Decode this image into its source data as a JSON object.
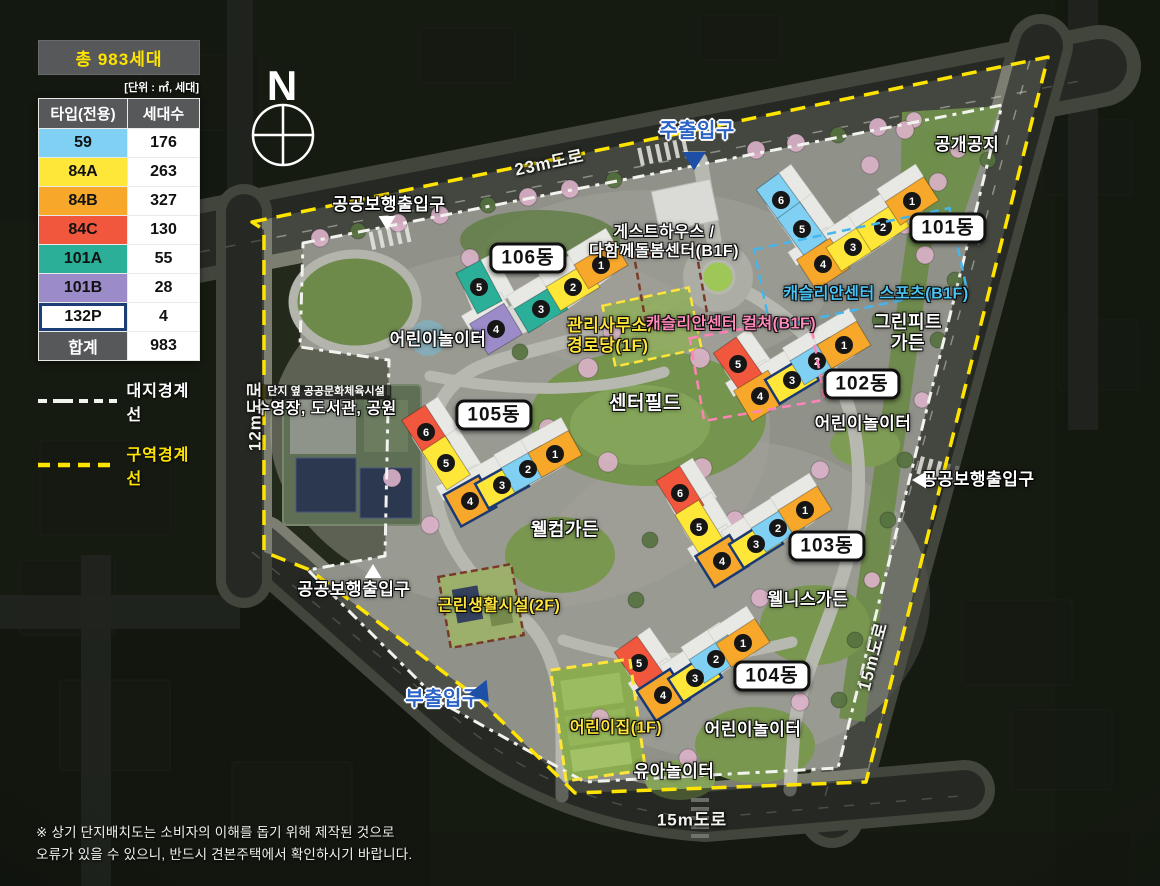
{
  "legend": {
    "title": "총 983세대",
    "unit_note": "[단위 : ㎡,  세대]",
    "col_type": "타입(전용)",
    "col_count": "세대수",
    "rows": [
      {
        "type": "59",
        "count": "176",
        "color": "#7fd0f2"
      },
      {
        "type": "84A",
        "count": "263",
        "color": "#ffe73a"
      },
      {
        "type": "84B",
        "count": "327",
        "color": "#f7a82b"
      },
      {
        "type": "84C",
        "count": "130",
        "color": "#f1573d"
      },
      {
        "type": "101A",
        "count": "55",
        "color": "#2baf98"
      },
      {
        "type": "101B",
        "count": "28",
        "color": "#9c8bc9"
      },
      {
        "type": "132P",
        "count": "4",
        "color": "#ffffff",
        "border": "#1c3e77"
      }
    ],
    "total_label": "합계",
    "total_count": "983",
    "boundary_site": "대지경계선",
    "boundary_zone": "구역경계선",
    "boundary_site_color": "#f2f2ee",
    "boundary_zone_color": "#ffe400"
  },
  "compass": {
    "label": "N"
  },
  "disclaimer": {
    "line1": "※ 상기 단지배치도는 소비자의 이해를 돕기 위해 제작된 것으로",
    "line2": "오류가 있을 수 있으니, 반드시 견본주택에서 확인하시기 바랍니다."
  },
  "site": {
    "unit_badge_color": "#161616",
    "buildings": [
      {
        "name": "101동",
        "pill": {
          "x": 948,
          "y": 228
        },
        "sections": [
          {
            "n": 6,
            "t": "59",
            "x": 781,
            "y": 200,
            "r": 54
          },
          {
            "n": 5,
            "t": "59",
            "x": 802,
            "y": 229,
            "r": 54
          },
          {
            "n": 4,
            "t": "84B",
            "x": 823,
            "y": 264,
            "r": -33,
            "c": true
          },
          {
            "n": 3,
            "t": "84A",
            "x": 853,
            "y": 247,
            "r": -33
          },
          {
            "n": 2,
            "t": "84A",
            "x": 883,
            "y": 227,
            "r": -33
          },
          {
            "n": 1,
            "t": "84B",
            "x": 912,
            "y": 201,
            "r": -33
          }
        ]
      },
      {
        "name": "102동",
        "pill": {
          "x": 862,
          "y": 384
        },
        "sections": [
          {
            "n": 5,
            "t": "84C",
            "x": 738,
            "y": 364,
            "r": 55
          },
          {
            "n": 4,
            "t": "84B",
            "x": 760,
            "y": 396,
            "r": -31,
            "c": true
          },
          {
            "n": 3,
            "t": "84A",
            "x": 792,
            "y": 380,
            "r": -31,
            "navy": true
          },
          {
            "n": 2,
            "t": "59",
            "x": 817,
            "y": 361,
            "r": -31
          },
          {
            "n": 1,
            "t": "84B",
            "x": 844,
            "y": 345,
            "r": -31
          }
        ]
      },
      {
        "name": "103동",
        "pill": {
          "x": 827,
          "y": 546
        },
        "sections": [
          {
            "n": 6,
            "t": "84C",
            "x": 680,
            "y": 493,
            "r": 58
          },
          {
            "n": 5,
            "t": "84A",
            "x": 699,
            "y": 527,
            "r": 58
          },
          {
            "n": 4,
            "t": "84B",
            "x": 722,
            "y": 561,
            "r": -32,
            "c": true,
            "navy": true
          },
          {
            "n": 3,
            "t": "84A",
            "x": 756,
            "y": 544,
            "r": -32,
            "navy": true
          },
          {
            "n": 2,
            "t": "59",
            "x": 778,
            "y": 528,
            "r": -32
          },
          {
            "n": 1,
            "t": "84B",
            "x": 805,
            "y": 510,
            "r": -32
          }
        ]
      },
      {
        "name": "104동",
        "pill": {
          "x": 772,
          "y": 676
        },
        "sections": [
          {
            "n": 5,
            "t": "84C",
            "x": 639,
            "y": 663,
            "r": 55
          },
          {
            "n": 4,
            "t": "84B",
            "x": 663,
            "y": 695,
            "r": -33,
            "c": true,
            "navy": true
          },
          {
            "n": 3,
            "t": "84A",
            "x": 695,
            "y": 678,
            "r": -33,
            "navy": true
          },
          {
            "n": 2,
            "t": "59",
            "x": 716,
            "y": 659,
            "r": -33
          },
          {
            "n": 1,
            "t": "84B",
            "x": 743,
            "y": 643,
            "r": -33
          }
        ]
      },
      {
        "name": "105동",
        "pill": {
          "x": 494,
          "y": 415
        },
        "sections": [
          {
            "n": 6,
            "t": "84C",
            "x": 426,
            "y": 432,
            "r": 57
          },
          {
            "n": 5,
            "t": "84A",
            "x": 446,
            "y": 463,
            "r": 57
          },
          {
            "n": 4,
            "t": "84B",
            "x": 470,
            "y": 501,
            "r": -29,
            "c": true,
            "navy": true
          },
          {
            "n": 3,
            "t": "84A",
            "x": 502,
            "y": 485,
            "r": -29,
            "navy": true
          },
          {
            "n": 2,
            "t": "59",
            "x": 528,
            "y": 469,
            "r": -29
          },
          {
            "n": 1,
            "t": "84B",
            "x": 555,
            "y": 454,
            "r": -29
          }
        ]
      },
      {
        "name": "106동",
        "pill": {
          "x": 528,
          "y": 258
        },
        "sections": [
          {
            "n": 5,
            "t": "101A",
            "x": 479,
            "y": 287,
            "r": 62
          },
          {
            "n": 4,
            "t": "101B",
            "x": 496,
            "y": 329,
            "r": -31,
            "c": true
          },
          {
            "n": 3,
            "t": "101A",
            "x": 541,
            "y": 309,
            "r": -31
          },
          {
            "n": 2,
            "t": "84A",
            "x": 573,
            "y": 287,
            "r": -31
          },
          {
            "n": 1,
            "t": "84B",
            "x": 601,
            "y": 265,
            "r": -31
          }
        ]
      }
    ]
  },
  "map_labels": [
    {
      "id": "open-space",
      "text": "공개공지",
      "x": 967,
      "y": 145,
      "s": "w",
      "fs": 17
    },
    {
      "id": "greenfit-garden",
      "text": "그린피트\n가든",
      "x": 908,
      "y": 333,
      "s": "w",
      "fs": 18
    },
    {
      "id": "center-field",
      "text": "센터필드",
      "x": 645,
      "y": 404,
      "s": "w",
      "fs": 19
    },
    {
      "id": "kids-playground-nw",
      "text": "어린이놀이터",
      "x": 438,
      "y": 340,
      "s": "w",
      "fs": 17
    },
    {
      "id": "kids-playground-e",
      "text": "어린이놀이터",
      "x": 863,
      "y": 424,
      "s": "w",
      "fs": 17
    },
    {
      "id": "kids-playground-s",
      "text": "어린이놀이터",
      "x": 753,
      "y": 730,
      "s": "w",
      "fs": 17
    },
    {
      "id": "welcome-garden",
      "text": "웰컴가든",
      "x": 565,
      "y": 530,
      "s": "w",
      "fs": 18
    },
    {
      "id": "wellness-garden",
      "text": "웰니스가든",
      "x": 808,
      "y": 600,
      "s": "w",
      "fs": 17
    },
    {
      "id": "toddler-playground",
      "text": "유아놀이터",
      "x": 674,
      "y": 772,
      "s": "w",
      "fs": 17
    },
    {
      "id": "guesthouse-care-center",
      "text": "게스트하우스 /\n다함께돌봄센터(B1F)",
      "x": 664,
      "y": 243,
      "s": "w",
      "fs": 16
    },
    {
      "id": "public-sports-note",
      "text": "단지 옆 공공문화체육시설",
      "x": 326,
      "y": 392,
      "s": "chip",
      "fs": 11
    },
    {
      "id": "pool-library-park",
      "text": "수영장, 도서관, 공원",
      "x": 326,
      "y": 410,
      "s": "w",
      "fs": 16
    },
    {
      "id": "management-office",
      "text": "관리사무소/\n경로당(1F)",
      "x": 567,
      "y": 336,
      "s": "y",
      "fs": 17,
      "align": "left"
    },
    {
      "id": "casllian-center-culture",
      "text": "캐슬리안센터 컬쳐(B1F)",
      "x": 731,
      "y": 325,
      "s": "pk",
      "fs": 16
    },
    {
      "id": "casllian-center-sports",
      "text": "캐슬리안센터 스포츠(B1F)",
      "x": 876,
      "y": 295,
      "s": "sb",
      "fs": 16
    },
    {
      "id": "neighborhood-facility",
      "text": "근린생활시설(2F)",
      "x": 499,
      "y": 607,
      "s": "y",
      "fs": 16
    },
    {
      "id": "daycare",
      "text": "어린이집(1F)",
      "x": 616,
      "y": 729,
      "s": "y",
      "fs": 16
    }
  ],
  "road_labels": [
    {
      "id": "road-23m",
      "text": "23m도로",
      "x": 549,
      "y": 161,
      "rot": -12
    },
    {
      "id": "road-12m",
      "text": "12m도로",
      "x": 253,
      "y": 416,
      "rot": -90
    },
    {
      "id": "road-15m-east",
      "text": "15m도로",
      "x": 871,
      "y": 656,
      "rot": -75
    },
    {
      "id": "road-15m-south",
      "text": "15m도로",
      "x": 692,
      "y": 818,
      "rot": 0
    }
  ],
  "entrances": [
    {
      "id": "main-entrance",
      "text": "주출입구",
      "x": 697,
      "y": 132,
      "c": "blue",
      "fs": 20,
      "tri": {
        "x": 694,
        "y": 161,
        "dir": "down",
        "c": "#1d4fa6",
        "w": 24,
        "h": 19,
        "rot": 0
      }
    },
    {
      "id": "sub-entrance",
      "text": "부출입구",
      "x": 443,
      "y": 700,
      "c": "blue",
      "fs": 20,
      "tri": {
        "x": 483,
        "y": 694,
        "dir": "down",
        "c": "#1d4fa6",
        "w": 24,
        "h": 19,
        "rot": -38
      }
    },
    {
      "id": "pedestrian-gate-nw",
      "text": "공공보행출입구",
      "x": 389,
      "y": 205,
      "c": "white",
      "fs": 17,
      "tri": {
        "x": 387,
        "y": 223,
        "dir": "down",
        "c": "#ffffff",
        "w": 17,
        "h": 14,
        "rot": 0
      }
    },
    {
      "id": "pedestrian-gate-sw",
      "text": "공공보행출입구",
      "x": 354,
      "y": 590,
      "c": "white",
      "fs": 17,
      "tri": {
        "x": 373,
        "y": 571,
        "dir": "up",
        "c": "#ffffff",
        "w": 17,
        "h": 14,
        "rot": 0
      }
    },
    {
      "id": "pedestrian-gate-e",
      "text": "공공보행출입구",
      "x": 978,
      "y": 480,
      "c": "white",
      "fs": 17,
      "tri": {
        "x": 919,
        "y": 480,
        "dir": "left",
        "c": "#ffffff",
        "w": 14,
        "h": 17,
        "rot": 0
      }
    }
  ]
}
